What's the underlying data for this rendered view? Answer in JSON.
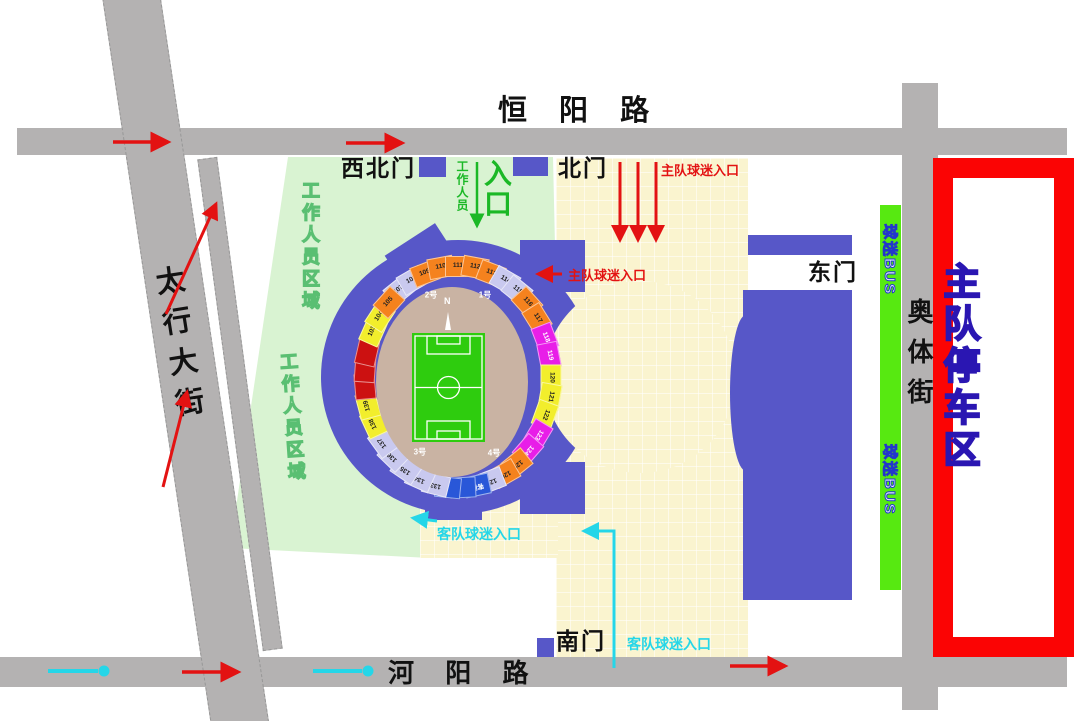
{
  "roads": {
    "north": "恒 阳 路",
    "west": "太行大街",
    "south": "河 阳 路",
    "east": "奥体街"
  },
  "gates": {
    "northwest": "西北门",
    "north": "北门",
    "east": "东门",
    "south": "南门"
  },
  "labels": {
    "staff_area": "工作人员区域",
    "staff": "工作人员",
    "entrance": "入口",
    "home_fans_entrance": "主队球迷入口",
    "away_fans_entrance": "客队球迷入口",
    "home_parking": "主队停车区",
    "fans_bus": "球迷BUS",
    "away_team_stand": "客队",
    "north_compass": "N"
  },
  "stadium": {
    "inner_gates": [
      {
        "label": "1号",
        "angle": 22
      },
      {
        "label": "2号",
        "angle": -22
      },
      {
        "label": "3号",
        "angle": -148
      },
      {
        "label": "4号",
        "angle": 150
      }
    ],
    "sections": [
      {
        "label": "107",
        "color": "lav",
        "angle": -39
      },
      {
        "label": "108",
        "color": "lav",
        "angle": -30
      },
      {
        "label": "109",
        "color": "org",
        "angle": -21
      },
      {
        "label": "110",
        "color": "org",
        "angle": -10.5
      },
      {
        "label": "111",
        "color": "org",
        "angle": 0
      },
      {
        "label": "112",
        "color": "org",
        "angle": 10.5
      },
      {
        "label": "113",
        "color": "org",
        "angle": 21
      },
      {
        "label": "114",
        "color": "lav",
        "angle": 30
      },
      {
        "label": "115",
        "color": "lav",
        "angle": 39
      },
      {
        "label": "116",
        "color": "org",
        "angle": 48
      },
      {
        "label": "117",
        "color": "org",
        "angle": 58
      },
      {
        "label": "118",
        "color": "mag",
        "angle": 69
      },
      {
        "label": "119",
        "color": "mag",
        "angle": 79
      },
      {
        "label": "120",
        "color": "yel",
        "angle": 90
      },
      {
        "label": "121",
        "color": "yel",
        "angle": 100
      },
      {
        "label": "122",
        "color": "yel",
        "angle": 110
      },
      {
        "label": "123",
        "color": "mag",
        "angle": 121
      },
      {
        "label": "124",
        "color": "mag",
        "angle": 131
      },
      {
        "label": "125",
        "color": "org",
        "angle": 141
      },
      {
        "label": "126",
        "color": "org",
        "angle": 150
      },
      {
        "label": "127",
        "color": "lav",
        "angle": 159
      },
      {
        "label": "客队",
        "color": "blu",
        "angle": 168
      },
      {
        "label": "",
        "color": "blu",
        "angle": 177
      },
      {
        "label": "",
        "color": "blu",
        "angle": 186
      },
      {
        "label": "133",
        "color": "lav",
        "angle": -166
      },
      {
        "label": "134",
        "color": "lav",
        "angle": -156
      },
      {
        "label": "135",
        "color": "lav",
        "angle": -146
      },
      {
        "label": "136",
        "color": "lav",
        "angle": -136
      },
      {
        "label": "137",
        "color": "lav",
        "angle": -126
      },
      {
        "label": "138",
        "color": "yel",
        "angle": -115
      },
      {
        "label": "139",
        "color": "yel",
        "angle": -105
      },
      {
        "label": "",
        "color": "red",
        "angle": -95
      },
      {
        "label": "",
        "color": "red",
        "angle": -86
      },
      {
        "label": "",
        "color": "red",
        "angle": -77
      },
      {
        "label": "103",
        "color": "yel",
        "angle": -66
      },
      {
        "label": "104",
        "color": "yel",
        "angle": -57
      },
      {
        "label": "105",
        "color": "org",
        "angle": -48
      }
    ]
  },
  "colors": {
    "road_gray": "#b4b2b2",
    "staff_green": "#d9f3d2",
    "plaza_cream": "#faf4cf",
    "stadium_blue": "#5757c8",
    "parking_red": "#fb0404",
    "bus_green": "#57e911",
    "pitch_green": "#2ecc0e",
    "track_tan": "#c9b3a3",
    "seat_lav": "#c9c9ef",
    "seat_org": "#f5821e",
    "seat_yel": "#f2ee2c",
    "seat_mag": "#e81ee8",
    "seat_red": "#cc1111",
    "seat_blu": "#2957d8",
    "arrow_red": "#e31212",
    "arrow_cyan": "#25d6e8",
    "entrance_green": "#1bb826"
  }
}
